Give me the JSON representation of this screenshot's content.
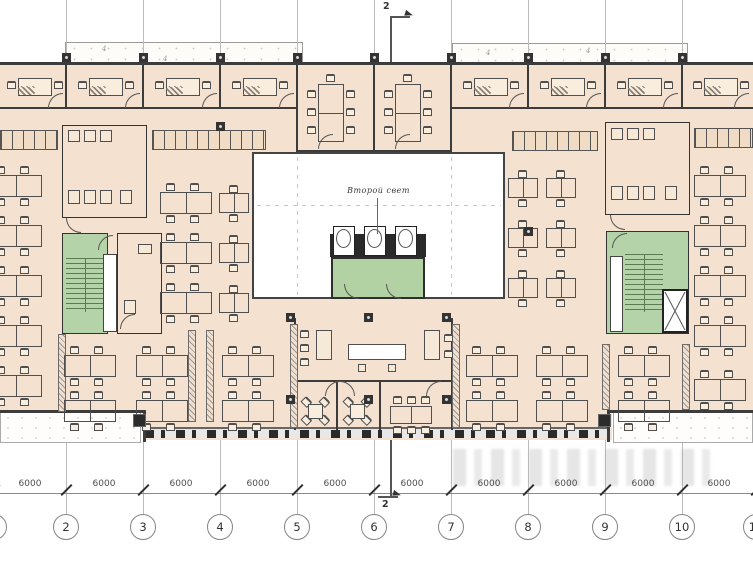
{
  "labels": {
    "atrium": "Второй свет",
    "section": "2",
    "dim": "6000",
    "canopy_mark": "4"
  },
  "grid": {
    "xs": [
      -6,
      66,
      143,
      220,
      297,
      374,
      451,
      528,
      605,
      682,
      756
    ],
    "numbers": [
      "1",
      "2",
      "3",
      "4",
      "5",
      "6",
      "7",
      "8",
      "9",
      "10",
      "11"
    ],
    "line_top": 0,
    "line_bottom": 514,
    "dim_y": 493,
    "dim_label_y": 479,
    "dim_centers": [
      30,
      104,
      181,
      258,
      335,
      412,
      489,
      566,
      643,
      719
    ],
    "bubble_cy": 527,
    "bubble_r": 13
  },
  "colors": {
    "floor": "#f4e1cf",
    "wall": "#3c3c3c",
    "stair_green": "#b5d3a8",
    "gridline": "#bcbcbc",
    "furniture": "#4f4f4f",
    "annotation": "#4e4e4e"
  },
  "geometry": {
    "walls": [
      [
        0,
        62,
        753,
        3
      ],
      [
        0,
        107,
        297,
        2
      ],
      [
        451,
        107,
        302,
        2
      ],
      [
        65,
        64,
        2,
        43
      ],
      [
        142,
        64,
        2,
        43
      ],
      [
        219,
        64,
        2,
        43
      ],
      [
        527,
        64,
        2,
        43
      ],
      [
        604,
        64,
        2,
        43
      ],
      [
        681,
        64,
        2,
        43
      ],
      [
        296,
        64,
        2,
        88
      ],
      [
        373,
        64,
        2,
        88
      ],
      [
        450,
        64,
        2,
        88
      ],
      [
        296,
        150,
        156,
        2
      ],
      [
        0,
        410,
        144,
        3
      ],
      [
        609,
        410,
        144,
        3
      ],
      [
        143,
        410,
        3,
        32
      ],
      [
        607,
        410,
        3,
        32
      ],
      [
        294,
        318,
        2,
        112
      ],
      [
        451,
        318,
        2,
        112
      ],
      [
        294,
        380,
        159,
        2
      ],
      [
        336,
        382,
        2,
        48
      ],
      [
        379,
        382,
        2,
        48
      ],
      [
        62,
        160,
        85,
        1.5
      ],
      [
        104,
        125,
        1.5,
        93
      ],
      [
        605,
        158,
        85,
        1.5
      ],
      [
        647,
        122,
        1.5,
        93
      ]
    ],
    "partitions": [
      [
        58,
        334,
        78
      ],
      [
        188,
        330,
        92
      ],
      [
        206,
        330,
        92
      ],
      [
        290,
        324,
        104
      ],
      [
        452,
        324,
        104
      ],
      [
        602,
        344,
        66
      ],
      [
        682,
        344,
        66
      ]
    ],
    "lockers": [
      [
        0,
        130,
        58
      ],
      [
        152,
        130,
        114
      ],
      [
        512,
        131,
        86
      ],
      [
        694,
        128,
        59
      ]
    ],
    "toilets": [
      [
        62,
        125,
        85,
        93
      ],
      [
        605,
        122,
        85,
        93
      ]
    ],
    "columns": [
      [
        66,
        57
      ],
      [
        143,
        57
      ],
      [
        220,
        57
      ],
      [
        297,
        57
      ],
      [
        374,
        57
      ],
      [
        451,
        57
      ],
      [
        528,
        57
      ],
      [
        605,
        57
      ],
      [
        682,
        57
      ],
      [
        220,
        126
      ],
      [
        528,
        231
      ],
      [
        290,
        317
      ],
      [
        368,
        317
      ],
      [
        446,
        317
      ],
      [
        290,
        399
      ],
      [
        368,
        399
      ],
      [
        446,
        399
      ]
    ],
    "junction_columns": [
      [
        139,
        420
      ],
      [
        604,
        420
      ]
    ],
    "arcs": [
      [
        48,
        93,
        0
      ],
      [
        125,
        93,
        0
      ],
      [
        202,
        93,
        0
      ],
      [
        279,
        93,
        0
      ],
      [
        509,
        93,
        0
      ],
      [
        586,
        93,
        0
      ],
      [
        663,
        93,
        0
      ],
      [
        734,
        93,
        0
      ],
      [
        318,
        134,
        0
      ],
      [
        395,
        134,
        0
      ],
      [
        98,
        235,
        0
      ],
      [
        612,
        233,
        0
      ],
      [
        325,
        381,
        0
      ],
      [
        340,
        381,
        1
      ],
      [
        426,
        381,
        0
      ],
      [
        120,
        314,
        0
      ],
      [
        66,
        218,
        2
      ],
      [
        610,
        215,
        2
      ],
      [
        344,
        284,
        2
      ],
      [
        386,
        284,
        2
      ]
    ],
    "elevator_cars": [
      333,
      364,
      395
    ],
    "small_rects": [
      [
        316,
        330,
        16,
        30
      ],
      [
        424,
        330,
        16,
        30
      ],
      [
        68,
        130,
        12,
        12
      ],
      [
        84,
        130,
        12,
        12
      ],
      [
        100,
        130,
        12,
        12
      ],
      [
        68,
        190,
        12,
        14
      ],
      [
        84,
        190,
        12,
        14
      ],
      [
        100,
        190,
        12,
        14
      ],
      [
        120,
        190,
        12,
        14
      ],
      [
        611,
        128,
        12,
        12
      ],
      [
        627,
        128,
        12,
        12
      ],
      [
        643,
        128,
        12,
        12
      ],
      [
        611,
        186,
        12,
        14
      ],
      [
        627,
        186,
        12,
        14
      ],
      [
        643,
        186,
        12,
        14
      ],
      [
        665,
        186,
        12,
        14
      ],
      [
        124,
        300,
        12,
        14
      ],
      [
        138,
        244,
        14,
        10
      ]
    ],
    "chairs": [
      [
        300,
        330
      ],
      [
        300,
        344
      ],
      [
        300,
        358
      ],
      [
        444,
        334
      ],
      [
        444,
        350
      ]
    ],
    "dashed_v": [
      297,
      451
    ],
    "dashed_h_y": 205,
    "clusters": [
      {
        "t": "bench4",
        "x": -10,
        "y": 166
      },
      {
        "t": "bench4",
        "x": -10,
        "y": 216
      },
      {
        "t": "bench4",
        "x": -10,
        "y": 266
      },
      {
        "t": "bench4",
        "x": -10,
        "y": 316
      },
      {
        "t": "bench4",
        "x": -10,
        "y": 366
      },
      {
        "t": "bench4",
        "x": 160,
        "y": 183
      },
      {
        "t": "bench4",
        "x": 160,
        "y": 233
      },
      {
        "t": "bench4",
        "x": 160,
        "y": 283
      },
      {
        "t": "bench2",
        "x": 219,
        "y": 185
      },
      {
        "t": "bench2",
        "x": 219,
        "y": 235
      },
      {
        "t": "bench2",
        "x": 219,
        "y": 285
      },
      {
        "t": "bench4",
        "x": 64,
        "y": 346
      },
      {
        "t": "bench4",
        "x": 64,
        "y": 391
      },
      {
        "t": "bench4",
        "x": 136,
        "y": 346
      },
      {
        "t": "bench4",
        "x": 136,
        "y": 391
      },
      {
        "t": "bench4",
        "x": 222,
        "y": 346
      },
      {
        "t": "bench4",
        "x": 222,
        "y": 391
      },
      {
        "t": "bench2",
        "x": 508,
        "y": 170
      },
      {
        "t": "bench2",
        "x": 546,
        "y": 170
      },
      {
        "t": "bench2",
        "x": 508,
        "y": 220
      },
      {
        "t": "bench2",
        "x": 546,
        "y": 220
      },
      {
        "t": "bench2",
        "x": 508,
        "y": 270
      },
      {
        "t": "bench2",
        "x": 546,
        "y": 270
      },
      {
        "t": "bench4",
        "x": 694,
        "y": 166
      },
      {
        "t": "bench4",
        "x": 694,
        "y": 216
      },
      {
        "t": "bench4",
        "x": 694,
        "y": 266
      },
      {
        "t": "bench4",
        "x": 694,
        "y": 316
      },
      {
        "t": "bench4",
        "x": 694,
        "y": 370
      },
      {
        "t": "bench4",
        "x": 466,
        "y": 346
      },
      {
        "t": "bench4",
        "x": 466,
        "y": 391
      },
      {
        "t": "bench4",
        "x": 536,
        "y": 346
      },
      {
        "t": "bench4",
        "x": 536,
        "y": 391
      },
      {
        "t": "bench4",
        "x": 618,
        "y": 346
      },
      {
        "t": "bench4",
        "x": 618,
        "y": 391
      },
      {
        "t": "deskL",
        "x": 18,
        "y": 70
      },
      {
        "t": "deskL",
        "x": 89,
        "y": 70
      },
      {
        "t": "deskL",
        "x": 166,
        "y": 70
      },
      {
        "t": "deskL",
        "x": 243,
        "y": 70
      },
      {
        "t": "deskL",
        "x": 474,
        "y": 70
      },
      {
        "t": "deskL",
        "x": 551,
        "y": 70
      },
      {
        "t": "deskL",
        "x": 628,
        "y": 70
      },
      {
        "t": "deskL",
        "x": 704,
        "y": 70
      },
      {
        "t": "conf",
        "x": 318,
        "y": 74
      },
      {
        "t": "conf",
        "x": 395,
        "y": 74
      },
      {
        "t": "confH",
        "x": 390,
        "y": 396
      },
      {
        "t": "cafe",
        "x": 302,
        "y": 398
      },
      {
        "t": "cafe",
        "x": 344,
        "y": 398
      },
      {
        "t": "counter",
        "x": 348,
        "y": 344
      }
    ],
    "canopy_marks": [
      [
        102,
        45
      ],
      [
        163,
        55
      ],
      [
        486,
        49
      ],
      [
        586,
        47
      ]
    ]
  },
  "watermark": {
    "icon": "watermark-blocks"
  }
}
